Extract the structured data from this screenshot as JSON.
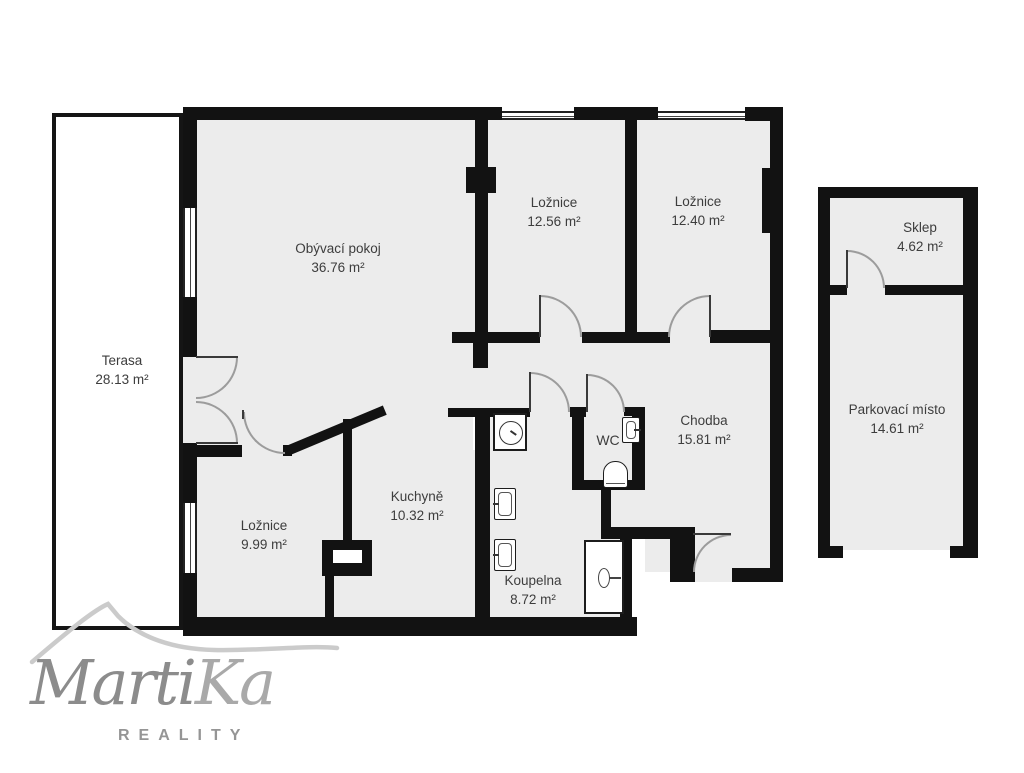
{
  "plan": {
    "rooms": [
      {
        "id": "obyvaci-pokoj",
        "name": "Obývací pokoj",
        "area": "36.76 m²"
      },
      {
        "id": "loznice-1",
        "name": "Ložnice",
        "area": "12.56 m²"
      },
      {
        "id": "loznice-2",
        "name": "Ložnice",
        "area": "12.40 m²"
      },
      {
        "id": "terasa",
        "name": "Terasa",
        "area": "28.13 m²"
      },
      {
        "id": "chodba",
        "name": "Chodba",
        "area": "15.81 m²"
      },
      {
        "id": "wc",
        "name": "WC",
        "area": ""
      },
      {
        "id": "kuchyne",
        "name": "Kuchyně",
        "area": "10.32 m²"
      },
      {
        "id": "loznice-3",
        "name": "Ložnice",
        "area": "9.99 m²"
      },
      {
        "id": "koupelna",
        "name": "Koupelna",
        "area": "8.72 m²"
      },
      {
        "id": "sklep",
        "name": "Sklep",
        "area": "4.62 m²"
      },
      {
        "id": "parkovaci-misto",
        "name": "Parkovací místo",
        "area": "14.61 m²"
      }
    ],
    "colors": {
      "wall": "#121212",
      "floor": "#ececec",
      "door_arc": "#9c9c9c"
    }
  },
  "logo": {
    "brand_part1": "Marti",
    "brand_part2": "Ka",
    "subtitle": "REALITY"
  }
}
